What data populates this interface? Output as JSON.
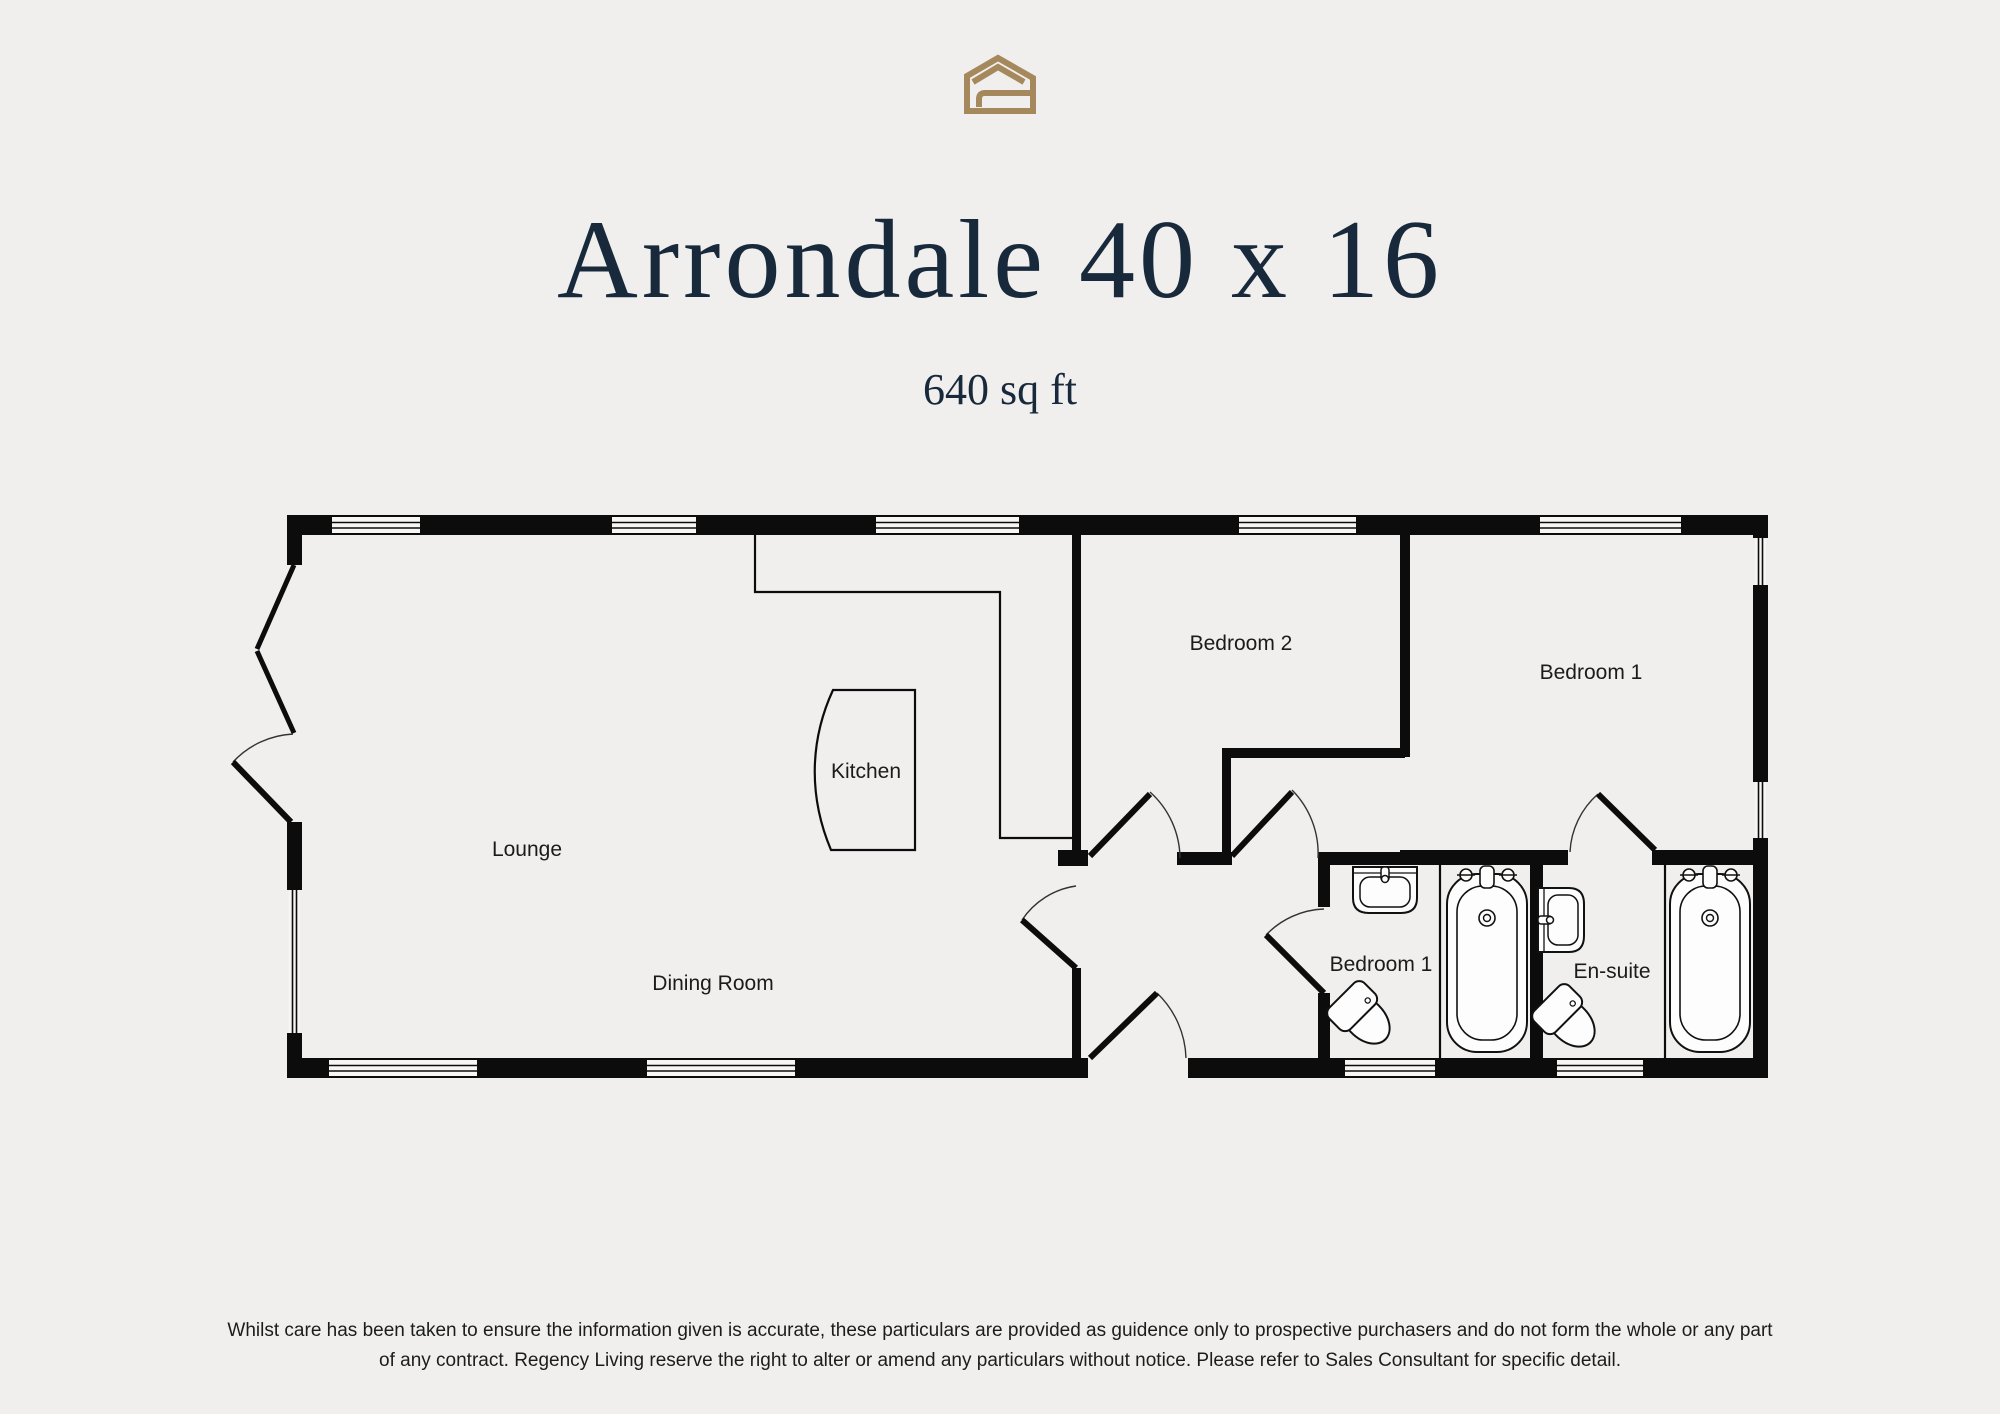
{
  "page": {
    "background_color": "#f0efee",
    "accent_gold": "#a5895c",
    "title_navy": "#17293a",
    "wall_color": "#0c0c0c"
  },
  "logo": {
    "icon": "regency-living-house-logo"
  },
  "header": {
    "title": "Arrondale 40 x 16",
    "subtitle": "640 sq ft"
  },
  "floorplan": {
    "room_labels": [
      {
        "id": "lounge",
        "label": "Lounge"
      },
      {
        "id": "dining-room",
        "label": "Dining Room"
      },
      {
        "id": "kitchen",
        "label": "Kitchen"
      },
      {
        "id": "bedroom-2",
        "label": "Bedroom 2"
      },
      {
        "id": "bedroom-1",
        "label": "Bedroom 1"
      },
      {
        "id": "bathroom",
        "label": "Bedroom 1"
      },
      {
        "id": "en-suite",
        "label": "En-suite"
      }
    ],
    "fixtures": [
      {
        "icon": "bath-icon"
      },
      {
        "icon": "bath-icon"
      },
      {
        "icon": "sink-icon"
      },
      {
        "icon": "sink-icon"
      },
      {
        "icon": "toilet-icon"
      },
      {
        "icon": "toilet-icon"
      }
    ]
  },
  "disclaimer": {
    "line1": "Whilst care has been taken to ensure the information given is accurate, these particulars are provided as guidence only to prospective purchasers and do not form the whole or any part",
    "line2": "of any contract. Regency Living reserve the right to alter or amend any particulars without notice. Please refer to Sales Consultant for specific detail."
  }
}
